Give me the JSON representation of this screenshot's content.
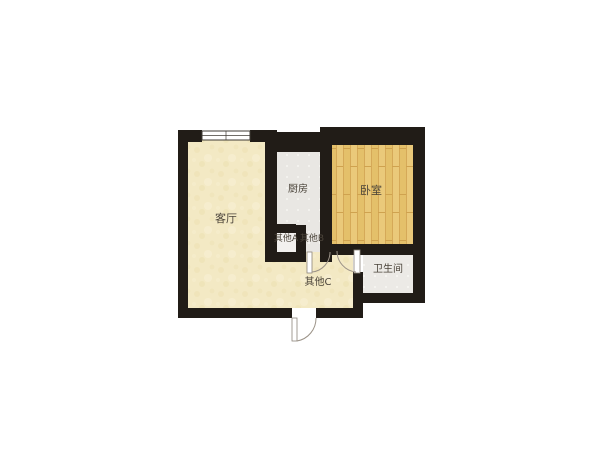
{
  "floorplan": {
    "rooms": [
      {
        "name": "living-room",
        "label": "客厅"
      },
      {
        "name": "kitchen",
        "label": "厨房"
      },
      {
        "name": "bedroom",
        "label": "卧室"
      },
      {
        "name": "other-a",
        "label": "其他A"
      },
      {
        "name": "other-b",
        "label": "其他B"
      },
      {
        "name": "other-c",
        "label": "其他C"
      },
      {
        "name": "bathroom",
        "label": "卫生间"
      }
    ],
    "colors": {
      "background": "#ffffff",
      "wall": "#211c17",
      "floor_warm": "#f3e9c4",
      "floor_warm_texture": "#ece0b2",
      "wood": "#eac97a",
      "wood_mid": "#e4c06a",
      "wood_dark": "#d5a958",
      "tile": "#e9e7e3",
      "tile_light": "#f3f2ee",
      "bath_tile": "#eceae6",
      "bath_tile_light": "#f5f4f0",
      "alcove": "#f2f0ee",
      "label_text": "#4b443a",
      "door_line": "#9b9287",
      "window_line": "#3f3b35"
    }
  }
}
